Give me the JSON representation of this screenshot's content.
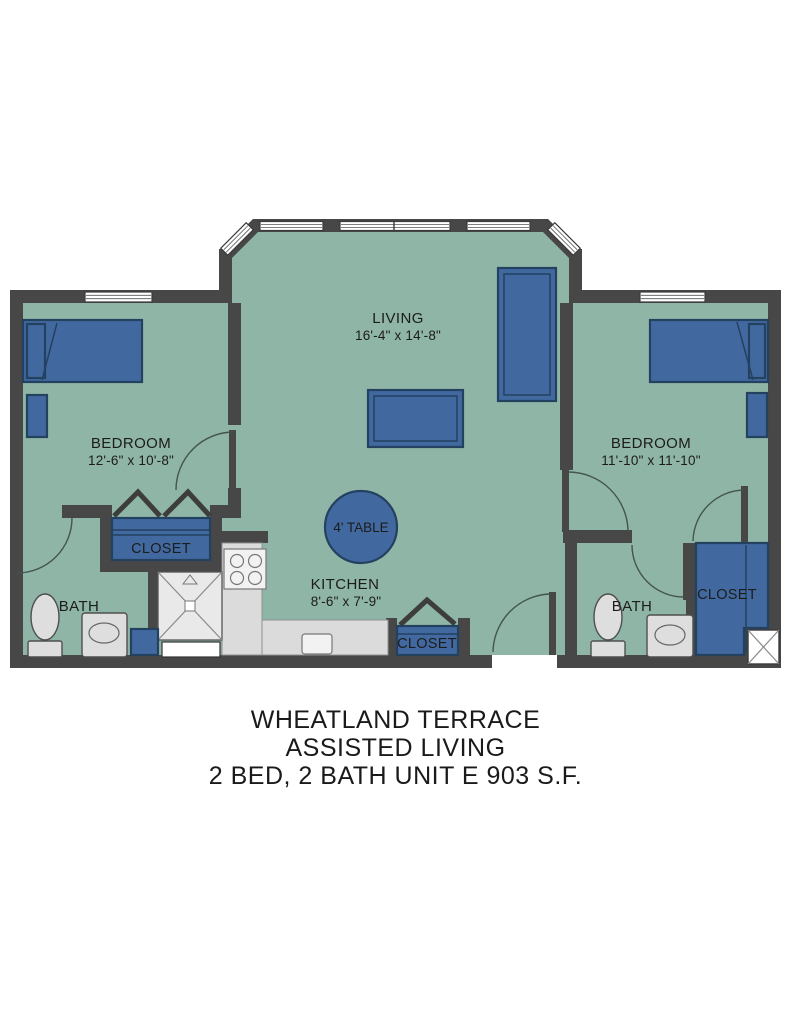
{
  "title": {
    "line1": "WHEATLAND TERRACE",
    "line2": "ASSISTED LIVING",
    "line3": "2 BED, 2 BATH  UNIT E 903 S.F."
  },
  "rooms": {
    "living": {
      "name": "LIVING",
      "dims": "16'-4\" x 14'-8\""
    },
    "bedroom_left": {
      "name": "BEDROOM",
      "dims": "12'-6\" x 10'-8\""
    },
    "bedroom_right": {
      "name": "BEDROOM",
      "dims": "11'-10\" x 11'-10\""
    },
    "kitchen": {
      "name": "KITCHEN",
      "dims": "8'-6\" x 7'-9\""
    },
    "bath_left": {
      "name": "BATH"
    },
    "bath_right": {
      "name": "BATH"
    },
    "closet_left": {
      "name": "CLOSET"
    },
    "closet_center": {
      "name": "CLOSET"
    },
    "closet_right": {
      "name": "CLOSET"
    },
    "table": {
      "name": "4' TABLE"
    }
  },
  "colors": {
    "floor": "#8FB5A6",
    "wall": "#474747",
    "furniture_blue": "#4169A0",
    "furniture_border": "#24415F",
    "fixture_gray": "#DEDEDE",
    "counter_gray": "#DBDBDB",
    "background": "#FFFFFF"
  }
}
